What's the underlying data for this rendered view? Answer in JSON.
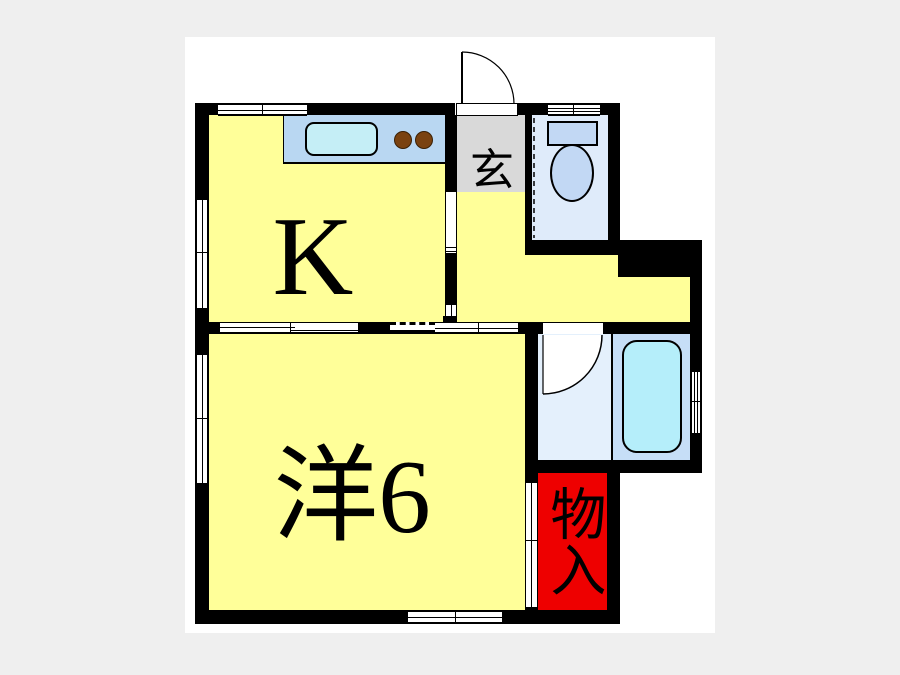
{
  "title": "1K apartment floor plan",
  "floorplan": {
    "labels": {
      "kitchen": "K",
      "entrance": "玄",
      "western_room": "洋6",
      "closet": "物入"
    },
    "rooms": [
      {
        "id": "kitchen",
        "label": "K",
        "fill": "#FFFF99"
      },
      {
        "id": "western_room",
        "label": "洋6",
        "fill": "#FFFF99"
      },
      {
        "id": "hallway",
        "label": "",
        "fill": "#FFFF99"
      },
      {
        "id": "entrance_genkan",
        "label": "玄",
        "fill": "#D9D9D9"
      },
      {
        "id": "toilet",
        "label": "",
        "fill": "#DFEBFA"
      },
      {
        "id": "washroom",
        "label": "",
        "fill": "#E4F0FC"
      },
      {
        "id": "bathroom",
        "label": "",
        "fill": "#C6DEF7"
      },
      {
        "id": "closet",
        "label": "物入",
        "fill": "#EE0000"
      }
    ],
    "colors": {
      "wall": "#000000",
      "room_yellow": "#FFFF99",
      "closet_red": "#EE0000",
      "genkan_gray": "#D9D9D9",
      "counter_blue": "#B9D7F2",
      "sink_cyan": "#C5EEF6",
      "burner_brown": "#7A4210",
      "toilet_room_blue": "#DFEBFA",
      "toilet_fixture_blue": "#C2D8F4",
      "washroom_blue": "#E4F0FC",
      "bath_blue": "#C6DEF7",
      "tub_cyan": "#B5EEFA",
      "canvas_white": "#FFFFFF",
      "page_gray": "#EFEFEF"
    }
  }
}
